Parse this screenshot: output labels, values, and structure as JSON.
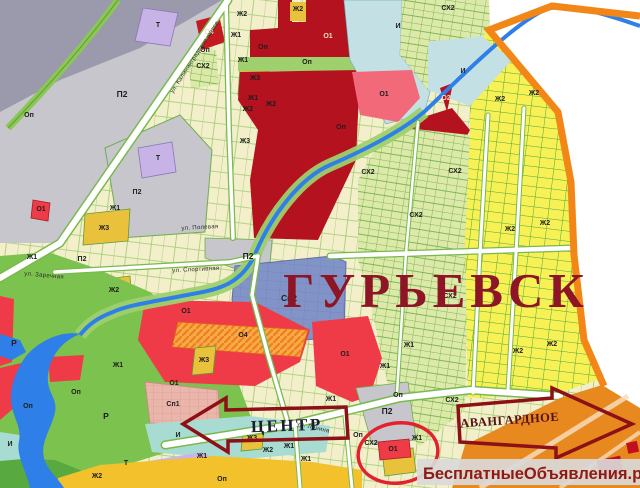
{
  "map": {
    "title": "ГУРЬЕВСК",
    "watermark": "БесплатныеОбъявления.рф",
    "arrow_left": "ЦЕНТР",
    "arrow_right": "АВАНГАРДНОЕ",
    "highlighted_zone": "О1",
    "zone_types_visible": [
      "Ж1",
      "Ж2",
      "Ж3",
      "О1",
      "О2",
      "О4",
      "Оп",
      "П2",
      "Р",
      "Т",
      "И",
      "СХ2",
      "Сп1",
      "Сп2"
    ],
    "colors": {
      "title_red": "#8e1526",
      "boundary_orange": "#f28718",
      "water_blue": "#2f7fe8",
      "arrow_outline": "#8c1016",
      "watermark_text": "#8f1a14",
      "highlight_ellipse_red": "#e3212e",
      "residential_yellow": "#f7f155",
      "public_red": "#b5121f",
      "industrial_gray": "#c6c6cc",
      "recreation_green": "#7cc24e"
    },
    "zone_labels": [
      {
        "t": "П2",
        "x": 122,
        "y": 97,
        "s": "lg"
      },
      {
        "t": "Оп",
        "x": 29,
        "y": 117
      },
      {
        "t": "Т",
        "x": 158,
        "y": 27
      },
      {
        "t": "О4",
        "x": 209,
        "y": 34,
        "s": "lt"
      },
      {
        "t": "Оп",
        "x": 205,
        "y": 52
      },
      {
        "t": "СХ2",
        "x": 203,
        "y": 68
      },
      {
        "t": "Ж2",
        "x": 242,
        "y": 16
      },
      {
        "t": "Ж1",
        "x": 236,
        "y": 37
      },
      {
        "t": "Оп",
        "x": 263,
        "y": 49
      },
      {
        "t": "Ж1",
        "x": 243,
        "y": 62
      },
      {
        "t": "Ж3",
        "x": 255,
        "y": 80
      },
      {
        "t": "Ж1",
        "x": 253,
        "y": 100
      },
      {
        "t": "Ж2",
        "x": 248,
        "y": 111
      },
      {
        "t": "Ж2",
        "x": 271,
        "y": 106
      },
      {
        "t": "Ж3",
        "x": 245,
        "y": 143
      },
      {
        "t": "Ж2",
        "x": 298,
        "y": 11
      },
      {
        "t": "О1",
        "x": 328,
        "y": 38,
        "s": "lt"
      },
      {
        "t": "И",
        "x": 398,
        "y": 28
      },
      {
        "t": "Оп",
        "x": 307,
        "y": 64
      },
      {
        "t": "О1",
        "x": 384,
        "y": 96
      },
      {
        "t": "О2",
        "x": 438,
        "y": 140,
        "s": "lt"
      },
      {
        "t": "Оп",
        "x": 341,
        "y": 129
      },
      {
        "t": "СХ2",
        "x": 448,
        "y": 10
      },
      {
        "t": "И",
        "x": 463,
        "y": 73
      },
      {
        "t": "О2",
        "x": 446,
        "y": 100,
        "s": "lt"
      },
      {
        "t": "Ж2",
        "x": 500,
        "y": 101
      },
      {
        "t": "Ж2",
        "x": 534,
        "y": 95
      },
      {
        "t": "Т",
        "x": 158,
        "y": 160
      },
      {
        "t": "П2",
        "x": 137,
        "y": 194
      },
      {
        "t": "Ж1",
        "x": 115,
        "y": 210
      },
      {
        "t": "Ж3",
        "x": 104,
        "y": 230
      },
      {
        "t": "О1",
        "x": 41,
        "y": 211
      },
      {
        "t": "Ж1",
        "x": 32,
        "y": 259
      },
      {
        "t": "П2",
        "x": 82,
        "y": 261
      },
      {
        "t": "Ж2",
        "x": 114,
        "y": 292
      },
      {
        "t": "Р",
        "x": 14,
        "y": 346,
        "s": "lg"
      },
      {
        "t": "О1",
        "x": 186,
        "y": 313
      },
      {
        "t": "О4",
        "x": 243,
        "y": 337
      },
      {
        "t": "П2",
        "x": 248,
        "y": 259,
        "s": "lg"
      },
      {
        "t": "Сп2",
        "x": 289,
        "y": 301,
        "s": "lg"
      },
      {
        "t": "Ж3",
        "x": 204,
        "y": 362
      },
      {
        "t": "Ж1",
        "x": 118,
        "y": 367
      },
      {
        "t": "О1",
        "x": 345,
        "y": 356
      },
      {
        "t": "О1",
        "x": 174,
        "y": 385
      },
      {
        "t": "Сп1",
        "x": 173,
        "y": 406
      },
      {
        "t": "Р",
        "x": 106,
        "y": 419,
        "s": "lg"
      },
      {
        "t": "И",
        "x": 178,
        "y": 437
      },
      {
        "t": "И",
        "x": 10,
        "y": 446
      },
      {
        "t": "Т",
        "x": 126,
        "y": 465
      },
      {
        "t": "Ж2",
        "x": 97,
        "y": 478
      },
      {
        "t": "Оп",
        "x": 76,
        "y": 394
      },
      {
        "t": "Оп",
        "x": 28,
        "y": 408
      },
      {
        "t": "Оп",
        "x": 222,
        "y": 481
      },
      {
        "t": "Ж1",
        "x": 202,
        "y": 458
      },
      {
        "t": "Ж2",
        "x": 268,
        "y": 452
      },
      {
        "t": "Ж1",
        "x": 289,
        "y": 448
      },
      {
        "t": "Ж1",
        "x": 306,
        "y": 461
      },
      {
        "t": "Ж3",
        "x": 252,
        "y": 440
      },
      {
        "t": "Ж1",
        "x": 331,
        "y": 401
      },
      {
        "t": "Оп",
        "x": 358,
        "y": 437
      },
      {
        "t": "П2",
        "x": 387,
        "y": 414,
        "s": "lg"
      },
      {
        "t": "СХ2",
        "x": 371,
        "y": 445
      },
      {
        "t": "О1",
        "x": 393,
        "y": 451
      },
      {
        "t": "Ж1",
        "x": 417,
        "y": 440
      },
      {
        "t": "СХ2",
        "x": 368,
        "y": 174
      },
      {
        "t": "СХ2",
        "x": 416,
        "y": 217
      },
      {
        "t": "СХ2",
        "x": 455,
        "y": 173
      },
      {
        "t": "СХ2",
        "x": 450,
        "y": 298
      },
      {
        "t": "СХ2",
        "x": 452,
        "y": 402
      },
      {
        "t": "Ж2",
        "x": 510,
        "y": 231
      },
      {
        "t": "Ж2",
        "x": 545,
        "y": 225
      },
      {
        "t": "Ж2",
        "x": 518,
        "y": 353
      },
      {
        "t": "Ж2",
        "x": 552,
        "y": 346
      },
      {
        "t": "Ж1",
        "x": 409,
        "y": 347
      },
      {
        "t": "Ж1",
        "x": 385,
        "y": 368
      },
      {
        "t": "Оп",
        "x": 398,
        "y": 397
      }
    ],
    "street_labels": [
      {
        "t": "ул. Калининградское шоссе",
        "x": 196,
        "y": 58,
        "r": -57
      },
      {
        "t": "ул. Спортивная",
        "x": 196,
        "y": 271,
        "r": -3
      },
      {
        "t": "ул. Заречная",
        "x": 44,
        "y": 277,
        "r": 5
      },
      {
        "t": "ул. Полевая",
        "x": 200,
        "y": 229,
        "r": -3
      },
      {
        "t": "ул. Ленина",
        "x": 313,
        "y": 429,
        "r": 13
      }
    ]
  }
}
